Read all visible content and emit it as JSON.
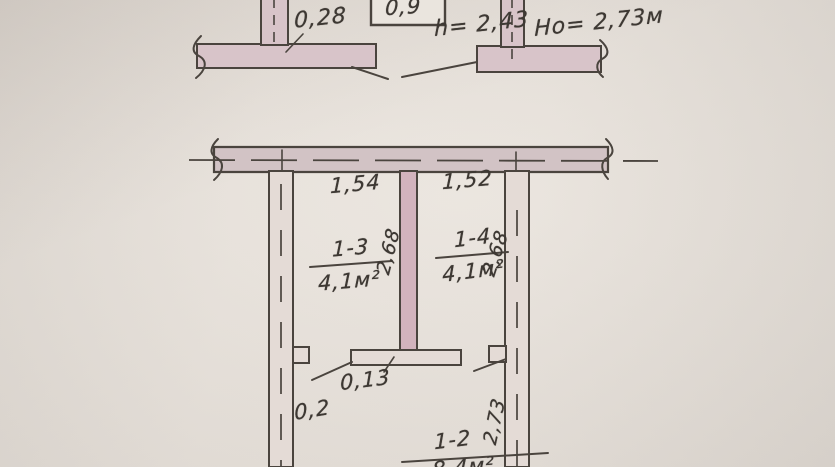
{
  "image": {
    "description": "Photographed hand-drawn apartment floor-plan fragment on aged paper (technical inventory drawing, Russian notation)"
  },
  "colors": {
    "paper": "#e8e3dc",
    "ink": "#4a443e",
    "wall_fill": "#d8c4c9",
    "partition_fill": "#d2b3bd"
  },
  "section_view": {
    "wall_width_label": "0,28",
    "door_width_label": "0,9",
    "door_height_label": "h= 2,43",
    "ceiling_height_label": "Но= 2,73м"
  },
  "plan_view": {
    "dim_room_left_width": "1,54",
    "dim_room_right_width": "1,52",
    "partition_end_label": "0,13",
    "wall_thickness_label": "0,2",
    "rooms": [
      {
        "id": "1-3",
        "area": "4,1м²",
        "depth": "2,68"
      },
      {
        "id": "1-4",
        "area": "4,1м²",
        "depth": "2,68"
      },
      {
        "id": "1-2",
        "area": "8,4м²",
        "depth": "2,73"
      }
    ]
  }
}
